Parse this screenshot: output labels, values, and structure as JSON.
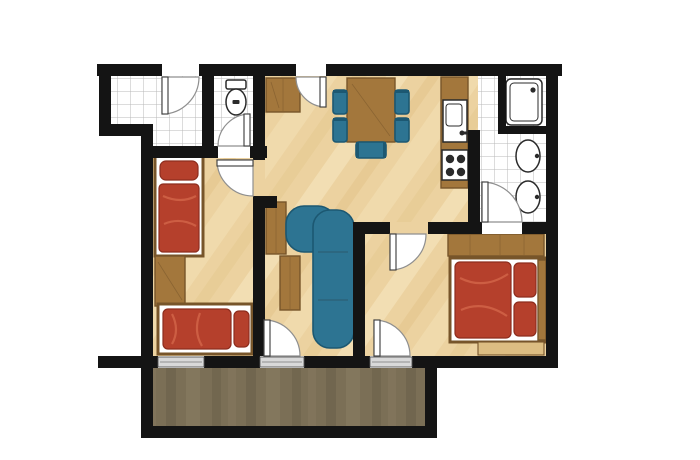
{
  "title": "apartment-floor-plan",
  "palette": {
    "wall": "#141414",
    "floor_wood": "#ecd2a0",
    "floor_wood_streak": "#f7e7c2",
    "floor_wood_shade": "#e0c186",
    "tile_bg": "#ffffff",
    "tile_line": "#b9b9b9",
    "deck_base": "#7b6f56",
    "deck_streak": "#675d47",
    "deck_light": "#8e8267",
    "furniture_wood": "#a3773c",
    "furniture_wood_dark": "#77552a",
    "furniture_wood_light": "#b98f51",
    "bed_red": "#b5402c",
    "bed_red_dark": "#8d2d1e",
    "bed_red_light": "#d3654a",
    "sofa_blue": "#2d7492",
    "sofa_blue_dark": "#1c5872",
    "fixture_white": "#ffffff",
    "fixture_stroke": "#2b2b2b",
    "door_arc": "#8f8f8f",
    "threshold": "#d9d9d9",
    "bench_wood": "#dcbd82"
  },
  "rooms": [
    {
      "id": "entry-hall",
      "label": "Entry hall",
      "floor": "tile",
      "items": [
        "entry door",
        "hall wardrobe"
      ]
    },
    {
      "id": "wc",
      "label": "WC",
      "floor": "tile",
      "items": [
        "toilet"
      ]
    },
    {
      "id": "bedroom-left",
      "label": "Left bedroom",
      "floor": "wood",
      "items": [
        "single bed 1",
        "single bed 2",
        "wardrobe"
      ]
    },
    {
      "id": "living-dining",
      "label": "Living / dining area",
      "floor": "wood",
      "items": [
        "dining table",
        "5 chairs",
        "L-sofa",
        "2 cabinets"
      ]
    },
    {
      "id": "kitchen",
      "label": "Kitchenette",
      "floor": "wood",
      "items": [
        "counter",
        "sink",
        "stove with 4 burners"
      ]
    },
    {
      "id": "bathroom",
      "label": "Bathroom",
      "floor": "tile",
      "items": [
        "shower",
        "washbasin 1",
        "washbasin 2"
      ]
    },
    {
      "id": "bedroom-right",
      "label": "Right bedroom",
      "floor": "wood",
      "items": [
        "double bed",
        "wardrobe",
        "bench"
      ]
    },
    {
      "id": "balcony",
      "label": "Balcony",
      "floor": "deck",
      "items": []
    }
  ],
  "counts": {
    "beds": 3,
    "chairs": 5,
    "washbasins": 2,
    "balcony_doors": 3,
    "door_swings": 8
  }
}
